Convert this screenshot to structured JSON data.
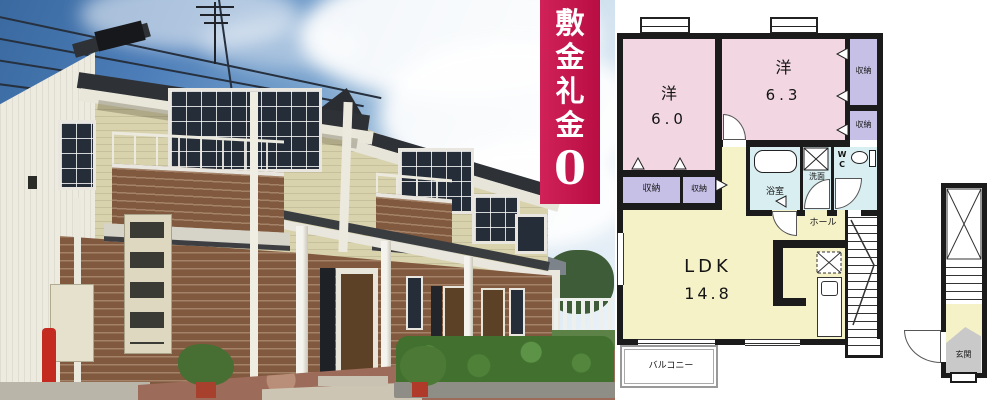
{
  "badge": {
    "chars": [
      "敷",
      "金",
      "礼",
      "金"
    ],
    "zero": "0",
    "bg_color": "#c3134e",
    "text_color": "#ffffff"
  },
  "floorplan": {
    "bedroom1": {
      "name": "洋",
      "area": "6.0"
    },
    "bedroom2": {
      "name": "洋",
      "area": "6.3"
    },
    "living": {
      "name": "LDK",
      "area": "14.8"
    },
    "labels": {
      "closet": "収納",
      "bath": "浴室",
      "washroom": "洗面",
      "wc_top": "W",
      "wc_bottom": "C",
      "hall": "ホール",
      "balcony": "バルコニー",
      "entrance": "玄関"
    },
    "colors": {
      "room_pink": "#f2d7e2",
      "closet_purple": "#c6c0e6",
      "living_yellow": "#f6f2c8",
      "wet_cyan": "#d9eef1",
      "entrance_gray": "#c9c9c9",
      "wall": "#1b1b1b"
    }
  },
  "photo": {
    "colors": {
      "sky_blue": "#4c7db8",
      "siding_cream": "#d8d2ad",
      "brick_brown": "#81593e",
      "hedge_green": "#41702f",
      "pavement_red": "#9c6b59"
    }
  }
}
